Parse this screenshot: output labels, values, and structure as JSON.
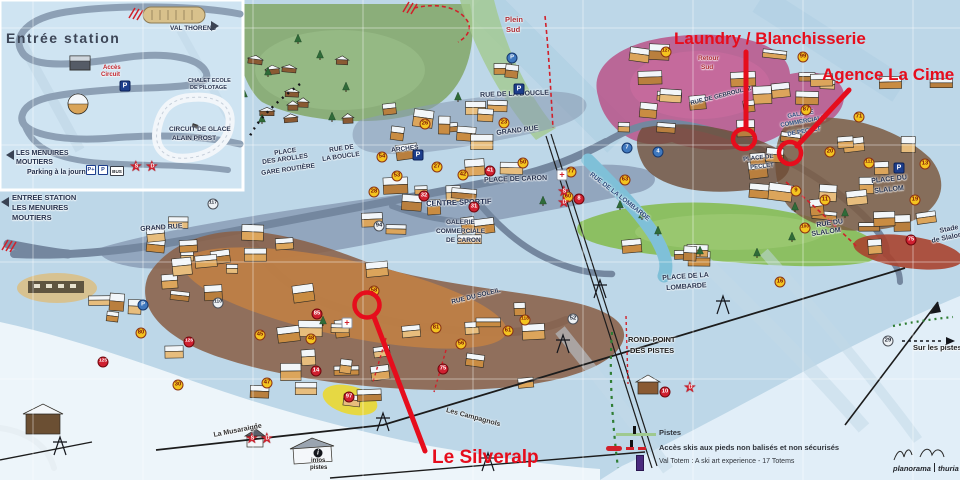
{
  "annotations": {
    "color": "#e60d1c",
    "laundry": {
      "label": "Laundry / Blanchisserie"
    },
    "agence": {
      "label": "Agence La Cime"
    },
    "silveralp": {
      "label": "Le Silveralp"
    }
  },
  "inset": {
    "title": "Entrée station",
    "badge_p_plus": "P+",
    "badge_p": "P",
    "badge_bus": "BUS"
  },
  "map_labels": [
    {
      "text": "VAL THORENS",
      "x": 170,
      "y": 26,
      "size": 6.5,
      "color": "#26324e",
      "rot": 0
    },
    {
      "text": "Accès",
      "x": 103,
      "y": 65,
      "size": 6,
      "color": "#c2232b",
      "rot": 0
    },
    {
      "text": "Circuit",
      "x": 101,
      "y": 72,
      "size": 6,
      "color": "#c2232b",
      "rot": 0
    },
    {
      "text": "CHALET ECOLE",
      "x": 188,
      "y": 79,
      "size": 5.5,
      "color": "#26324e",
      "rot": 0
    },
    {
      "text": "DE PILOTAGE",
      "x": 190,
      "y": 86,
      "size": 5.5,
      "color": "#26324e",
      "rot": 0
    },
    {
      "text": "CIRCUIT DE GLACE",
      "x": 169,
      "y": 127,
      "size": 6.5,
      "color": "#26324e",
      "rot": 0
    },
    {
      "text": "ALAIN PROST",
      "x": 172,
      "y": 136,
      "size": 6.5,
      "color": "#26324e",
      "rot": 0
    },
    {
      "text": "LES MENUIRES",
      "x": 16,
      "y": 150,
      "size": 7,
      "color": "#26324e",
      "rot": 0
    },
    {
      "text": "MOUTIERS",
      "x": 16,
      "y": 159,
      "size": 7,
      "color": "#26324e",
      "rot": 0
    },
    {
      "text": "Parking à la journée",
      "x": 27,
      "y": 169,
      "size": 7,
      "color": "#26324e",
      "rot": 0
    },
    {
      "text": "ENTREE STATION",
      "x": 12,
      "y": 194,
      "size": 7.5,
      "color": "#26324e",
      "rot": 0
    },
    {
      "text": "LES MENUIRES",
      "x": 12,
      "y": 204,
      "size": 7.5,
      "color": "#26324e",
      "rot": 0
    },
    {
      "text": "MOUTIERS",
      "x": 12,
      "y": 214,
      "size": 7.5,
      "color": "#26324e",
      "rot": 0
    },
    {
      "text": "GRAND RUE",
      "x": 140,
      "y": 226,
      "size": 7,
      "color": "#26324e",
      "rot": -4
    },
    {
      "text": "GRAND RUE",
      "x": 496,
      "y": 130,
      "size": 7,
      "color": "#26324e",
      "rot": -7
    },
    {
      "text": "RUE DE",
      "x": 329,
      "y": 148,
      "size": 6.5,
      "color": "#26324e",
      "rot": -8
    },
    {
      "text": "LA BOUCLE",
      "x": 322,
      "y": 157,
      "size": 6.5,
      "color": "#26324e",
      "rot": -8
    },
    {
      "text": "RUE DE LA BOUCLE",
      "x": 480,
      "y": 92,
      "size": 7,
      "color": "#26324e",
      "rot": -2
    },
    {
      "text": "PLACE",
      "x": 274,
      "y": 151,
      "size": 6.5,
      "color": "#26324e",
      "rot": -8
    },
    {
      "text": "DES AROLLES",
      "x": 262,
      "y": 160,
      "size": 6.5,
      "color": "#26324e",
      "rot": -8
    },
    {
      "text": "GARE ROUTIÈRE",
      "x": 261,
      "y": 171,
      "size": 6.5,
      "color": "#26324e",
      "rot": -8
    },
    {
      "text": "ARCHES",
      "x": 391,
      "y": 148,
      "size": 6.5,
      "color": "#26324e",
      "rot": -6
    },
    {
      "text": "PLACE DE CARON",
      "x": 484,
      "y": 177,
      "size": 7,
      "color": "#26324e",
      "rot": -2
    },
    {
      "text": "CENTRE SPORTIF",
      "x": 426,
      "y": 200,
      "size": 7.5,
      "color": "#1f2c4e",
      "rot": -2
    },
    {
      "text": "GALERIE",
      "x": 446,
      "y": 220,
      "size": 6.5,
      "color": "#26324e",
      "rot": 0
    },
    {
      "text": "COMMERCIALE",
      "x": 436,
      "y": 229,
      "size": 6.5,
      "color": "#26324e",
      "rot": 0
    },
    {
      "text": "DE CARON",
      "x": 446,
      "y": 238,
      "size": 6.5,
      "color": "#26324e",
      "rot": 0
    },
    {
      "text": "GALERIE",
      "x": 787,
      "y": 114,
      "size": 6,
      "color": "#2c4a7c",
      "rot": -10
    },
    {
      "text": "COMMERCIALE",
      "x": 780,
      "y": 123,
      "size": 6,
      "color": "#2c4a7c",
      "rot": -10
    },
    {
      "text": "DE PECLET",
      "x": 787,
      "y": 132,
      "size": 6,
      "color": "#2c4a7c",
      "rot": -10
    },
    {
      "text": "PLACE DE",
      "x": 743,
      "y": 157,
      "size": 6,
      "color": "#26324e",
      "rot": -6
    },
    {
      "text": "PECLET",
      "x": 750,
      "y": 165,
      "size": 6,
      "color": "#26324e",
      "rot": -6
    },
    {
      "text": "RUE DE GEBROULAZ",
      "x": 690,
      "y": 101,
      "size": 6,
      "color": "#26324e",
      "rot": -14
    },
    {
      "text": "RUE DE LA LOMBARDE",
      "x": 592,
      "y": 172,
      "size": 6.5,
      "color": "#2c4a7c",
      "rot": 38
    },
    {
      "text": "PLACE DE LA",
      "x": 662,
      "y": 275,
      "size": 7,
      "color": "#26324e",
      "rot": -4
    },
    {
      "text": "LOMBARDE",
      "x": 666,
      "y": 285,
      "size": 7,
      "color": "#26324e",
      "rot": -4
    },
    {
      "text": "PLACE DU",
      "x": 871,
      "y": 178,
      "size": 7,
      "color": "#26324e",
      "rot": -6
    },
    {
      "text": "SLALOM",
      "x": 874,
      "y": 188,
      "size": 7,
      "color": "#26324e",
      "rot": -6
    },
    {
      "text": "RUE DU",
      "x": 816,
      "y": 222,
      "size": 7,
      "color": "#26324e",
      "rot": -8
    },
    {
      "text": "SLALOM",
      "x": 811,
      "y": 231,
      "size": 7,
      "color": "#26324e",
      "rot": -8
    },
    {
      "text": "Stade",
      "x": 939,
      "y": 228,
      "size": 7,
      "color": "#26324e",
      "rot": -12
    },
    {
      "text": "de Slalom",
      "x": 931,
      "y": 238,
      "size": 7,
      "color": "#26324e",
      "rot": -12
    },
    {
      "text": "ROND-POINT",
      "x": 628,
      "y": 336,
      "size": 7.5,
      "color": "#222222",
      "rot": 0
    },
    {
      "text": "DES PISTES",
      "x": 630,
      "y": 347,
      "size": 7.5,
      "color": "#222222",
      "rot": 0
    },
    {
      "text": "RUE DU SOLEIL",
      "x": 451,
      "y": 300,
      "size": 6.5,
      "color": "#26324e",
      "rot": -14
    },
    {
      "text": "Les Campagnols",
      "x": 447,
      "y": 407,
      "size": 7,
      "color": "#333333",
      "rot": 15
    },
    {
      "text": "La Musaraigne",
      "x": 213,
      "y": 432,
      "size": 7,
      "color": "#333333",
      "rot": -11
    },
    {
      "text": "Plein",
      "x": 505,
      "y": 16,
      "size": 7.5,
      "color": "#b03038",
      "rot": 0
    },
    {
      "text": "Sud",
      "x": 506,
      "y": 26,
      "size": 7.5,
      "color": "#b03038",
      "rot": 0
    },
    {
      "text": "Retour",
      "x": 698,
      "y": 56,
      "size": 6.5,
      "color": "#b03038",
      "rot": 0
    },
    {
      "text": "Sud",
      "x": 701,
      "y": 65,
      "size": 6.5,
      "color": "#b03038",
      "rot": 0
    },
    {
      "text": "Sur les pistes",
      "x": 913,
      "y": 344,
      "size": 7.5,
      "color": "#222222",
      "rot": 0
    },
    {
      "text": "infos",
      "x": 311,
      "y": 458,
      "size": 6,
      "color": "#222222",
      "rot": 0
    },
    {
      "text": "pistes",
      "x": 310,
      "y": 465,
      "size": 6,
      "color": "#222222",
      "rot": 0
    }
  ],
  "markers": [
    {
      "label": "127",
      "x": 666,
      "y": 52,
      "type": "yellow"
    },
    {
      "label": "99",
      "x": 803,
      "y": 57,
      "type": "yellow"
    },
    {
      "label": "87",
      "x": 806,
      "y": 110,
      "type": "yellow"
    },
    {
      "label": "71",
      "x": 859,
      "y": 117,
      "type": "yellow"
    },
    {
      "label": "26",
      "x": 425,
      "y": 124,
      "type": "yellow"
    },
    {
      "label": "23",
      "x": 504,
      "y": 123,
      "type": "yellow"
    },
    {
      "label": "54",
      "x": 382,
      "y": 157,
      "type": "yellow"
    },
    {
      "label": "27",
      "x": 437,
      "y": 167,
      "type": "yellow"
    },
    {
      "label": "53",
      "x": 397,
      "y": 176,
      "type": "yellow"
    },
    {
      "label": "42",
      "x": 463,
      "y": 175,
      "type": "yellow"
    },
    {
      "label": "50",
      "x": 523,
      "y": 163,
      "type": "yellow"
    },
    {
      "label": "28",
      "x": 374,
      "y": 192,
      "type": "yellow"
    },
    {
      "label": "58",
      "x": 374,
      "y": 291,
      "type": "yellow"
    },
    {
      "label": "81",
      "x": 436,
      "y": 328,
      "type": "yellow"
    },
    {
      "label": "56",
      "x": 461,
      "y": 344,
      "type": "yellow"
    },
    {
      "label": "118",
      "x": 525,
      "y": 320,
      "type": "yellow"
    },
    {
      "label": "61",
      "x": 508,
      "y": 331,
      "type": "yellow"
    },
    {
      "label": "20",
      "x": 830,
      "y": 152,
      "type": "yellow"
    },
    {
      "label": "11",
      "x": 825,
      "y": 200,
      "type": "yellow"
    },
    {
      "label": "111",
      "x": 869,
      "y": 163,
      "type": "yellow"
    },
    {
      "label": "13",
      "x": 925,
      "y": 164,
      "type": "yellow"
    },
    {
      "label": "19",
      "x": 915,
      "y": 200,
      "type": "yellow"
    },
    {
      "label": "9",
      "x": 796,
      "y": 191,
      "type": "yellow"
    },
    {
      "label": "100",
      "x": 805,
      "y": 228,
      "type": "yellow"
    },
    {
      "label": "16",
      "x": 780,
      "y": 282,
      "type": "yellow"
    },
    {
      "label": "77",
      "x": 571,
      "y": 172,
      "type": "yellow"
    },
    {
      "label": "60",
      "x": 568,
      "y": 197,
      "type": "yellow"
    },
    {
      "label": "63",
      "x": 625,
      "y": 180,
      "type": "yellow"
    },
    {
      "label": "30",
      "x": 178,
      "y": 385,
      "type": "yellow"
    },
    {
      "label": "45",
      "x": 260,
      "y": 335,
      "type": "yellow"
    },
    {
      "label": "47",
      "x": 267,
      "y": 383,
      "type": "yellow"
    },
    {
      "label": "48",
      "x": 311,
      "y": 339,
      "type": "yellow"
    },
    {
      "label": "80",
      "x": 141,
      "y": 333,
      "type": "yellow"
    },
    {
      "label": "110",
      "x": 218,
      "y": 303,
      "type": "gray"
    },
    {
      "label": "117",
      "x": 213,
      "y": 204,
      "type": "gray"
    },
    {
      "label": "94",
      "x": 379,
      "y": 226,
      "type": "gray"
    },
    {
      "label": "52",
      "x": 573,
      "y": 319,
      "type": "gray"
    },
    {
      "label": "29",
      "x": 888,
      "y": 341,
      "type": "gray"
    },
    {
      "label": "41",
      "x": 490,
      "y": 171,
      "type": "red"
    },
    {
      "label": "32",
      "x": 424,
      "y": 196,
      "type": "red"
    },
    {
      "label": "31",
      "x": 474,
      "y": 207,
      "type": "red"
    },
    {
      "label": "85",
      "x": 317,
      "y": 314,
      "type": "red"
    },
    {
      "label": "14",
      "x": 316,
      "y": 371,
      "type": "red"
    },
    {
      "label": "126",
      "x": 189,
      "y": 342,
      "type": "red"
    },
    {
      "label": "125",
      "x": 103,
      "y": 362,
      "type": "red"
    },
    {
      "label": "97",
      "x": 349,
      "y": 397,
      "type": "red"
    },
    {
      "label": "75",
      "x": 443,
      "y": 369,
      "type": "red"
    },
    {
      "label": "75",
      "x": 911,
      "y": 240,
      "type": "red"
    },
    {
      "label": "10",
      "x": 665,
      "y": 392,
      "type": "red"
    },
    {
      "label": "8",
      "x": 579,
      "y": 199,
      "type": "red"
    },
    {
      "label": "7",
      "x": 627,
      "y": 148,
      "type": "blue"
    },
    {
      "label": "4",
      "x": 658,
      "y": 152,
      "type": "blue"
    },
    {
      "label": "P",
      "x": 512,
      "y": 58,
      "type": "blue"
    },
    {
      "label": "P",
      "x": 143,
      "y": 305,
      "type": "blue"
    },
    {
      "label": "P",
      "x": 418,
      "y": 155,
      "type": "p"
    },
    {
      "label": "P",
      "x": 519,
      "y": 89,
      "type": "p"
    },
    {
      "label": "P",
      "x": 899,
      "y": 168,
      "type": "p"
    },
    {
      "label": "P",
      "x": 125,
      "y": 86,
      "type": "p"
    },
    {
      "label": "i",
      "x": 318,
      "y": 453,
      "type": "info"
    },
    {
      "label": "+",
      "x": 562,
      "y": 175,
      "type": "cross"
    },
    {
      "label": "+",
      "x": 347,
      "y": 323,
      "type": "cross"
    },
    {
      "label": "S",
      "x": 565,
      "y": 193,
      "type": "star"
    },
    {
      "label": "D",
      "x": 565,
      "y": 204,
      "type": "star"
    },
    {
      "label": "S",
      "x": 253,
      "y": 440,
      "type": "star"
    },
    {
      "label": "D",
      "x": 268,
      "y": 440,
      "type": "star"
    },
    {
      "label": "D",
      "x": 691,
      "y": 389,
      "type": "star"
    },
    {
      "label": "S",
      "x": 137,
      "y": 168,
      "type": "star"
    },
    {
      "label": "D",
      "x": 153,
      "y": 168,
      "type": "star"
    }
  ],
  "legend": {
    "rows": [
      {
        "label": "Pistes"
      },
      {
        "label": "Accès skis aux pieds non balisés et non sécurisés"
      },
      {
        "label": "Val Totem : A ski art experience - 17 Totems"
      }
    ],
    "signature_left": "planorama",
    "signature_right": "thuria"
  }
}
